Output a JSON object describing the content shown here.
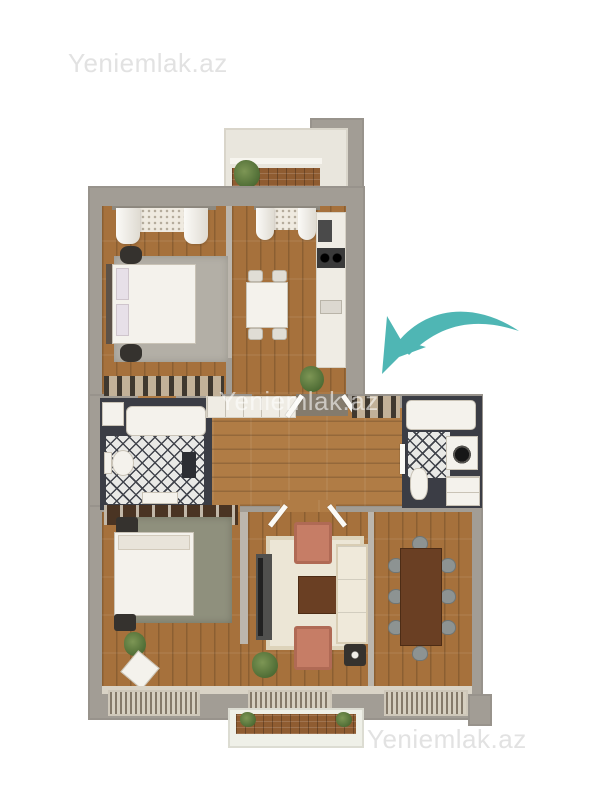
{
  "watermarks": {
    "top_left": "Yeniemlak.az",
    "center": "Yeniemlak.az",
    "bottom_right": "Yeniemlak.az"
  },
  "icons": {
    "arrow": "curved-arrow-icon"
  },
  "colors": {
    "watermark_gray": "#e2e2e2",
    "arrow_teal": "#4fb6b4",
    "wall_gray": "#a29d95",
    "wood_brown": "#a6713c",
    "bathroom_dark": "#3b3d45",
    "sofa_cream": "#efe9da",
    "armchair_salmon": "#c67d66",
    "table_brown": "#6a3f23",
    "rug_cream": "#ece6d6",
    "plant_green": "#4c6a33"
  }
}
